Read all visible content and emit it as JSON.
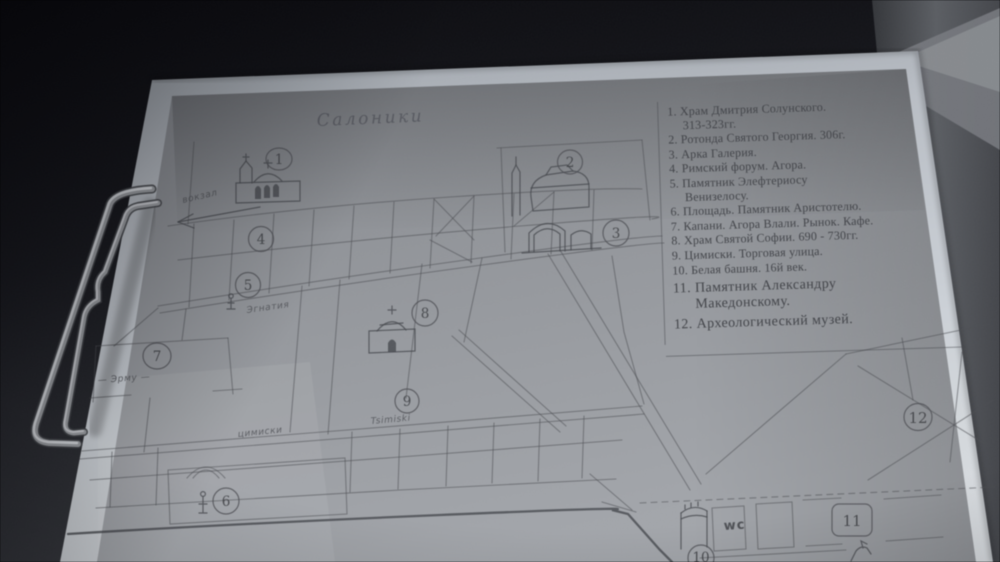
{
  "scene": {
    "description": "Photo of a hand-drawn tourist map of Thessaloniki clipped to a clipboard",
    "background_color": "#0b0b0f",
    "side_panel_color": "#55585e",
    "paper_color": "#ccd1d8",
    "print_color": "#989ba1",
    "ink_color": "#4c4e54"
  },
  "map": {
    "title": "Салоники",
    "labels": {
      "station": "вокзал",
      "egnatia": "Эгнатия",
      "ermou": "— Эрму —",
      "tsimiski_cyr": "цимиски",
      "tsimiski_lat": "Tsimiski",
      "wc": "wc"
    },
    "markers": [
      {
        "n": "1"
      },
      {
        "n": "2"
      },
      {
        "n": "3"
      },
      {
        "n": "4"
      },
      {
        "n": "5"
      },
      {
        "n": "6"
      },
      {
        "n": "7"
      },
      {
        "n": "8"
      },
      {
        "n": "9"
      },
      {
        "n": "10"
      },
      {
        "n": "11"
      },
      {
        "n": "12"
      }
    ]
  },
  "legend": {
    "items": [
      {
        "num": "1.",
        "lines": [
          "Храм Дмитрия Солунского.",
          "313-323гг."
        ],
        "large": false
      },
      {
        "num": "2.",
        "lines": [
          "Ротонда Святого Георгия. 306г."
        ],
        "large": false
      },
      {
        "num": "3.",
        "lines": [
          "Арка Галерия."
        ],
        "large": false
      },
      {
        "num": "4.",
        "lines": [
          "Римский форум. Агора."
        ],
        "large": false
      },
      {
        "num": "5.",
        "lines": [
          "Памятник Элефтериосу",
          "Венизелосу."
        ],
        "large": false
      },
      {
        "num": "6.",
        "lines": [
          "Площадь. Памятник Аристотелю."
        ],
        "large": false
      },
      {
        "num": "7.",
        "lines": [
          "Капани. Агора Влали. Рынок. Кафе."
        ],
        "large": false
      },
      {
        "num": "8.",
        "lines": [
          "Храм Святой Софии. 690 - 730гг."
        ],
        "large": false
      },
      {
        "num": "9.",
        "lines": [
          "Цимиски. Торговая улица."
        ],
        "large": false
      },
      {
        "num": "10.",
        "lines": [
          "Белая башня. 16й век."
        ],
        "large": false
      },
      {
        "num": "11.",
        "lines": [
          "Памятник Александру",
          "Македонскому."
        ],
        "large": true
      },
      {
        "num": "12.",
        "lines": [
          "Археологический музей."
        ],
        "large": true
      }
    ]
  }
}
